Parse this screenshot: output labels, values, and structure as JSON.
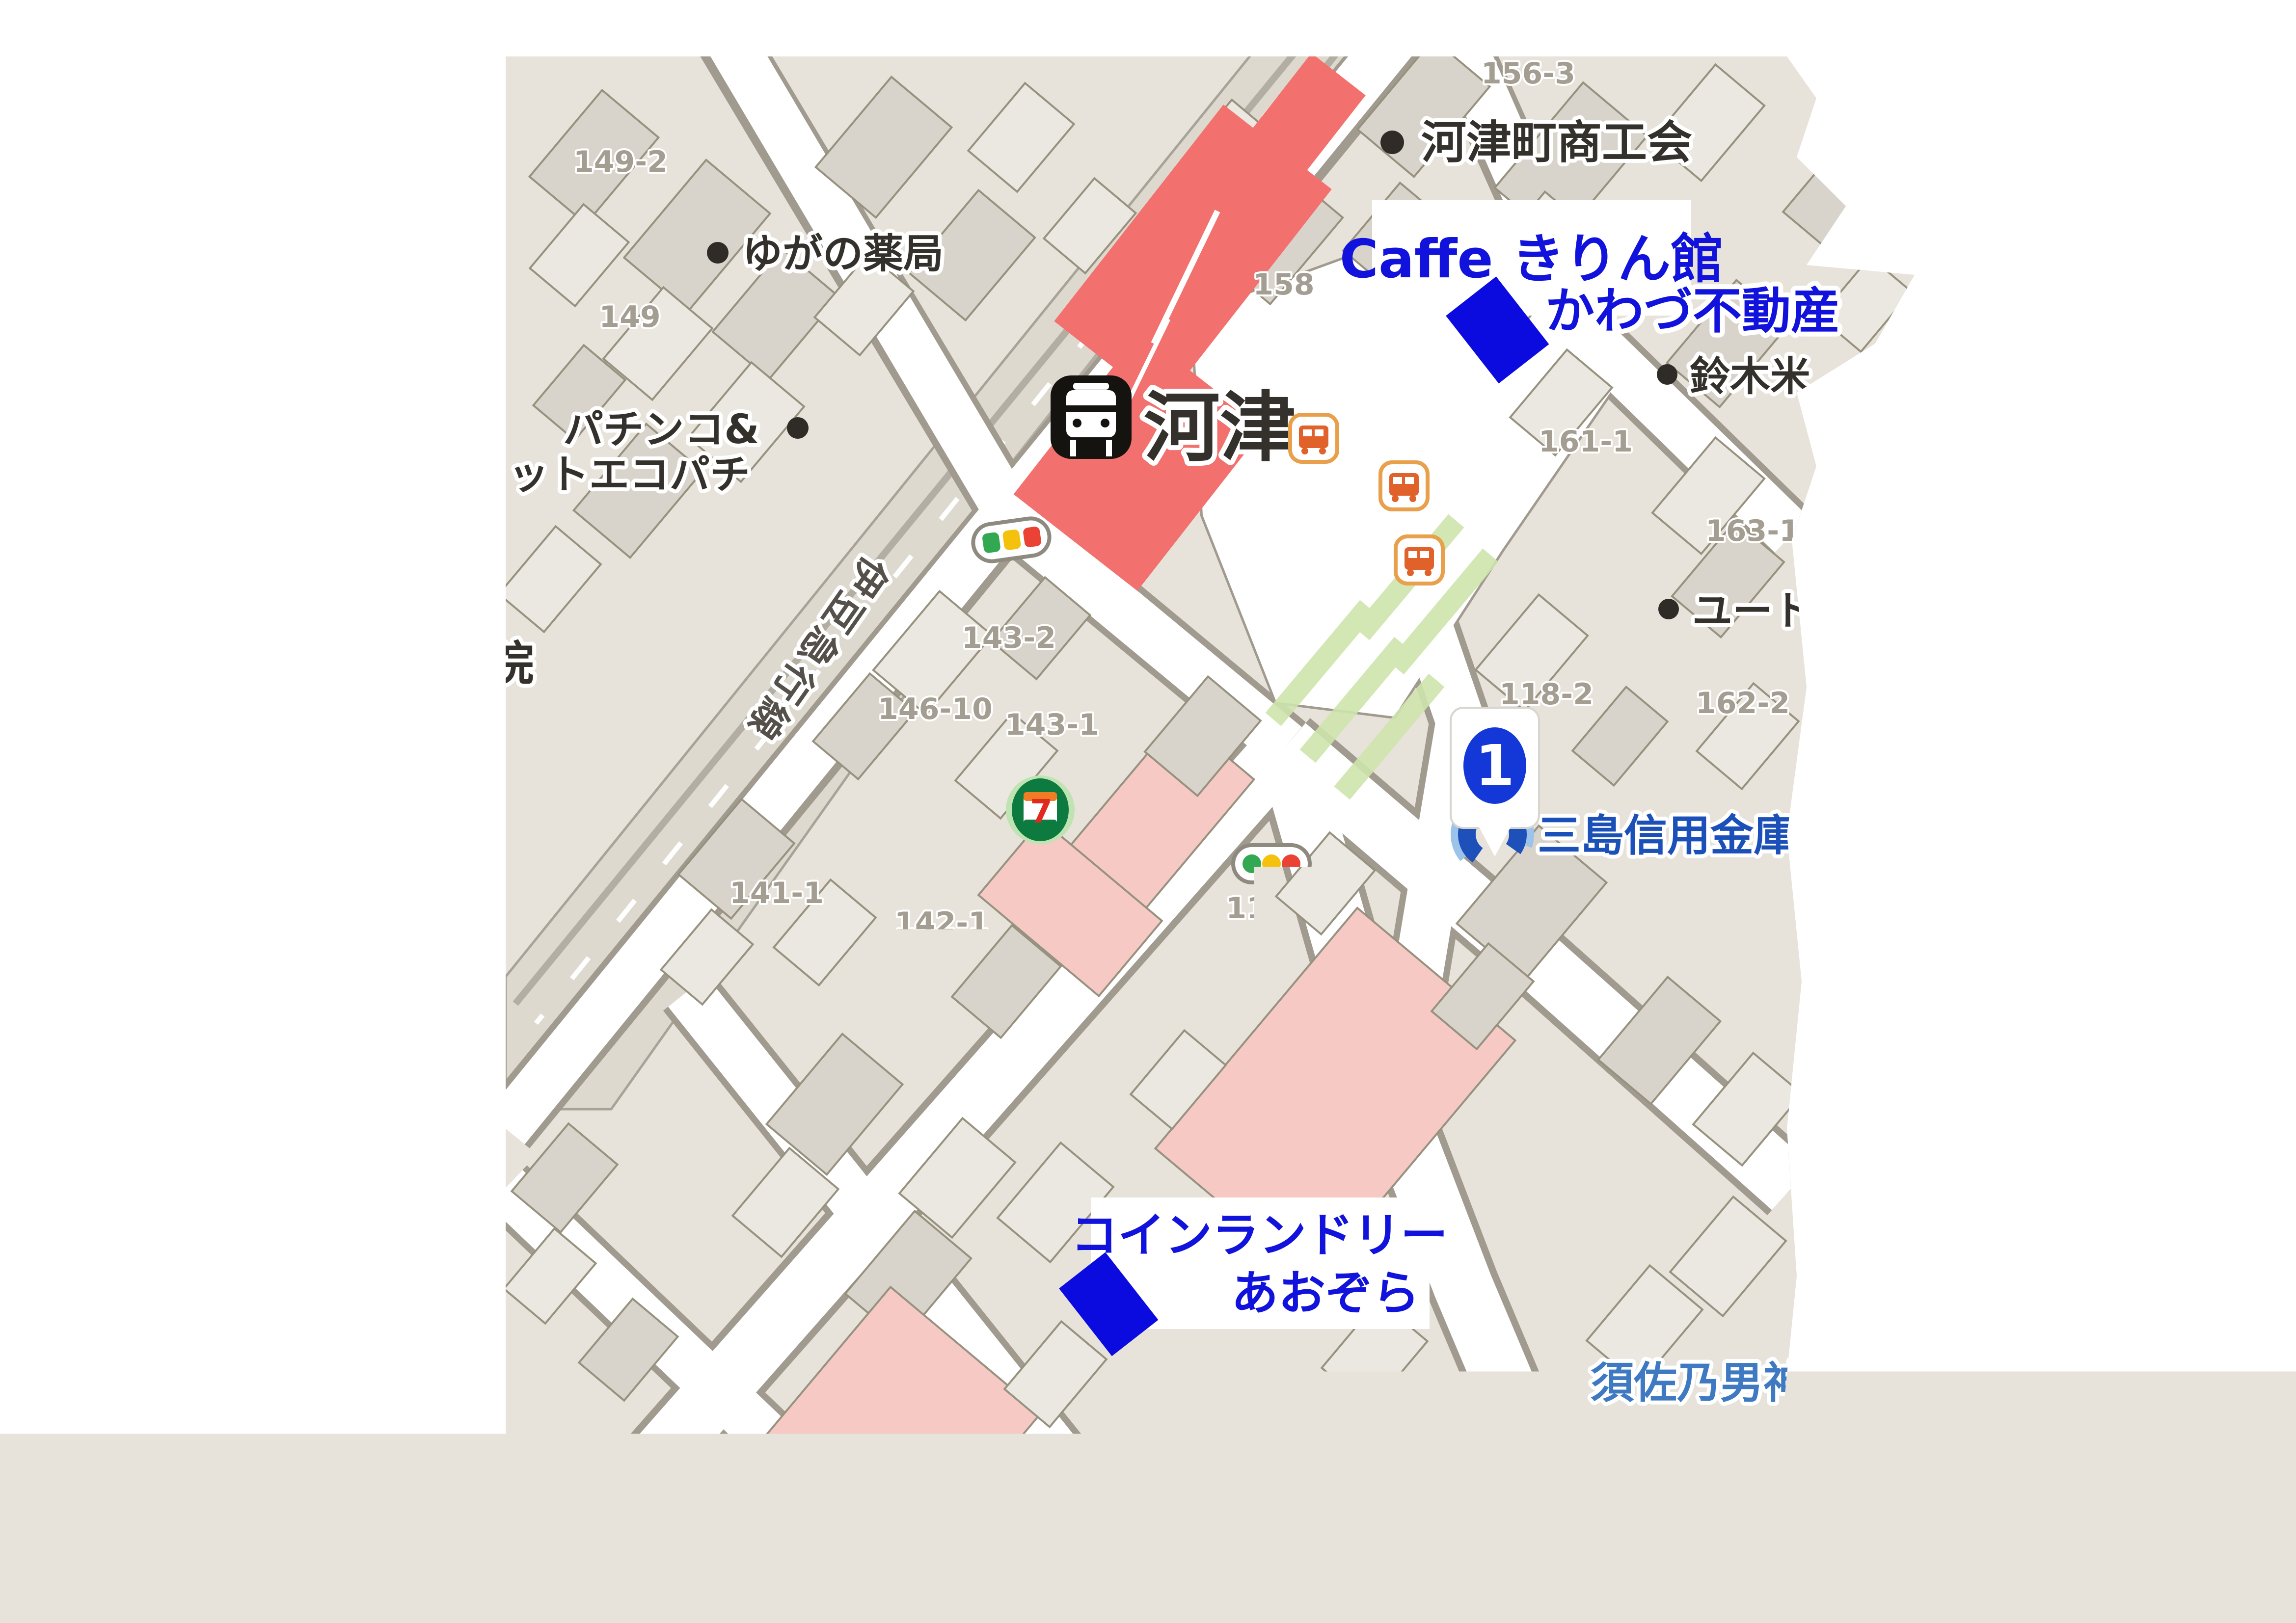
{
  "map": {
    "type": "annotated-street-map",
    "station": {
      "name": "河津",
      "icon": "train-station-icon"
    },
    "railway": {
      "line_name": "伊豆急行線"
    },
    "annotations": {
      "caffe_kirin": "Caffe きりん館",
      "kawazu_fudosan": "かわづ不動産",
      "coin_laundry_line1": "コインランドリー",
      "coin_laundry_line2": "あおぞら",
      "marker1_number": "1"
    },
    "poi": {
      "shokokai": "河津町商工会",
      "yugano_pharmacy": "ゆがの薬局",
      "pachinko_line1": "パチンコ&",
      "pachinko_line2": "ットエコパチ",
      "hospital_partial": "院",
      "suzuki_rice": "鈴木米",
      "yuto": "ユート",
      "suzuki_milk": "鈴木牛乳店",
      "mishima_bank": "三島信用金庫河",
      "maxvalu_line1": "マックスバリュ",
      "maxvalu_line2": "エクスプレス",
      "foodstore_aoki": "フードストアあおき",
      "welcia": "ウエルシア",
      "hama": "浜",
      "susanoo_shrine": "須佐乃男神社",
      "seven_eleven_glyph": "7"
    },
    "lots": {
      "l156_3": "156-3",
      "l149_2": "149-2",
      "l149": "149",
      "l158": "158",
      "l161_1": "161-1",
      "l163_1": "163-1",
      "l162_2": "162-2",
      "l118_2": "118-2",
      "l146_10": "146-10",
      "l143_2": "143-2",
      "l143_1": "143-1",
      "l141_1": "141-1",
      "l142_1": "142-1",
      "l113": "113",
      "l114": "114",
      "l121": "121",
      "l302_2": "302-2",
      "l109_6": "109-6",
      "l105_1": "105-1",
      "l93_7": "93-7",
      "l93_2": "93-2",
      "l81_3": "81-3",
      "l95_2": "95-2",
      "l108": "108",
      "l109_2": "109-2",
      "l27_2": "27-2",
      "l26_2": "26-2"
    },
    "colors": {
      "block_beige": "#e8e3da",
      "building_gray": "#d9d4cb",
      "road_white": "#ffffff",
      "station_red": "#f2716f",
      "commercial_pink": "#f6c9c5",
      "annotation_blue": "#1212dd",
      "bank_blue": "#1b50b8",
      "shrine_blue": "#3e79c2",
      "store_pink": "#c94f8e",
      "traffic_green": "#33a852",
      "traffic_yellow": "#f4c20d",
      "traffic_red": "#ea4335",
      "bus_orange": "#e0622a"
    }
  }
}
